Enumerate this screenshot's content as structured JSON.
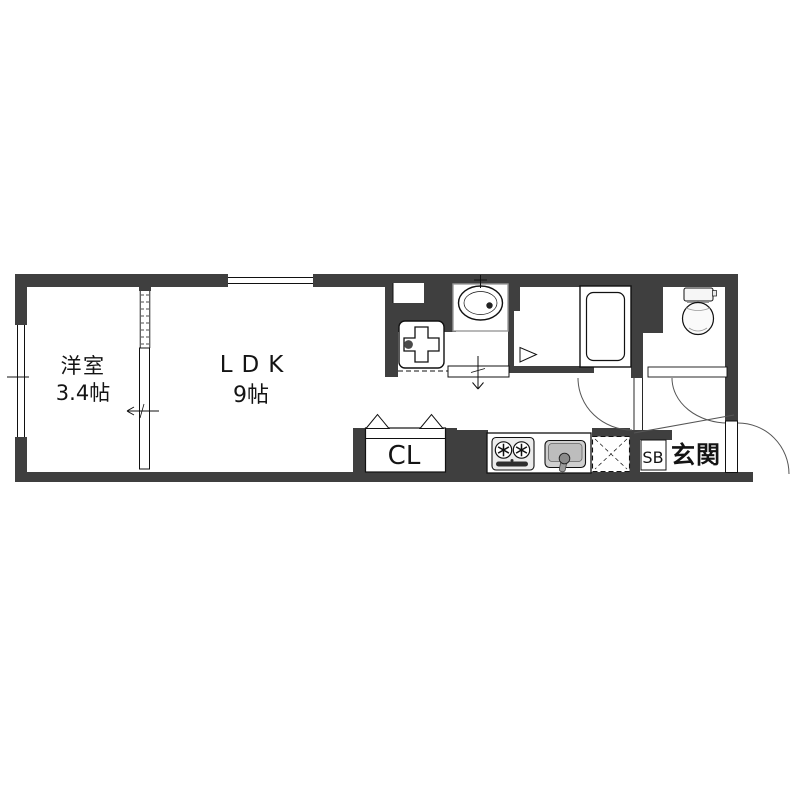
{
  "floorplan": {
    "type": "apartment-1ldk-floor-plan",
    "rooms": [
      {
        "name": "洋室",
        "size": "3.4帖"
      },
      {
        "name": "LDK",
        "size": "9帖"
      },
      {
        "name": "CL"
      },
      {
        "name": "SB"
      },
      {
        "name": "玄関"
      }
    ],
    "fixtures": [
      "wash-basin",
      "washing-machine-pan",
      "bathtub",
      "toilet",
      "gas-stove-two-burner",
      "kitchen-sink",
      "refrigerator-space",
      "closet-bifold-door",
      "bedroom-sliding-door",
      "washroom-sliding-door",
      "bath-folding-door",
      "hall-hinged-door",
      "toilet-hinged-door",
      "entrance-door",
      "window-top",
      "window-left",
      "genkan-step-line"
    ],
    "colors": {
      "wall": "#3f3f3f",
      "line": "#111111",
      "arc": "#555555",
      "background": "#ffffff",
      "fixture_gray": "#c9c9c9"
    }
  }
}
